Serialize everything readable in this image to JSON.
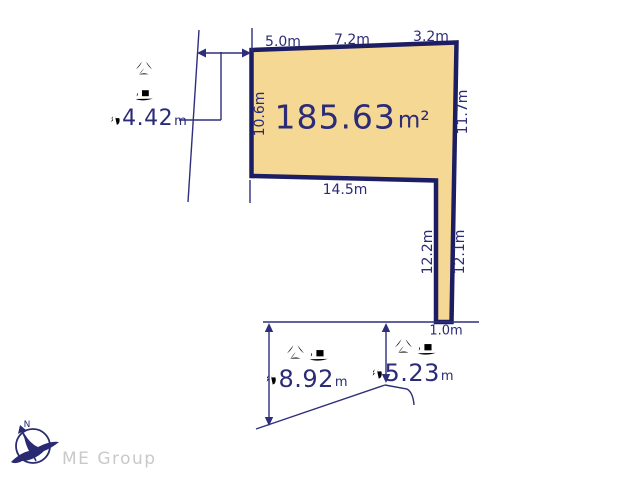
{
  "colors": {
    "parcel_fill": "#f5d893",
    "parcel_border": "#1d1d63",
    "line_navy": "#2e2e7d",
    "text_navy": "#2b2b76",
    "logo_gray": "#c9c9c9"
  },
  "parcel": {
    "area_value": "185.63",
    "area_unit": "m²",
    "top_dims": [
      "5.0m",
      "7.2m",
      "3.2m"
    ],
    "left_dim": "10.6m",
    "right_dim": "11.7m",
    "bottom_dim": "14.5m",
    "strip_left_dim": "12.2m",
    "strip_right_dim": "12.1m",
    "strip_bottom_dim": "1.0m"
  },
  "roads": {
    "west": {
      "name": "公道",
      "approx": "約",
      "width_value": "4.42",
      "width_unit": "m"
    },
    "south_left": {
      "name": "公道",
      "approx": "約",
      "width_value": "8.92",
      "width_unit": "m"
    },
    "south_right": {
      "name": "公道",
      "approx": "約",
      "width_value": "5.23",
      "width_unit": "m"
    }
  },
  "logo": {
    "company": "ME Group",
    "compass_letter": "N"
  }
}
